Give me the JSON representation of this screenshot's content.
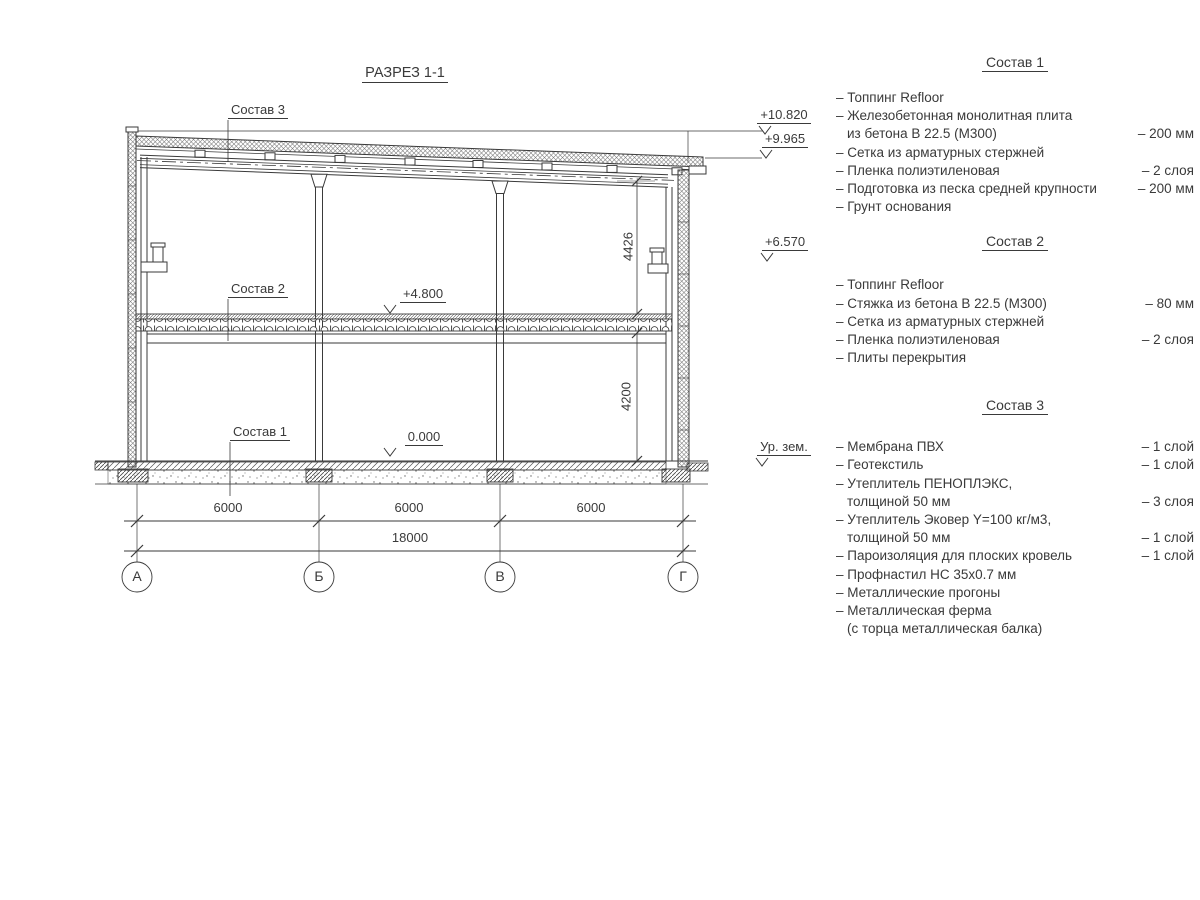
{
  "title": "РАЗРЕЗ 1-1",
  "colors": {
    "ink": "#3a3a3a",
    "background": "#ffffff"
  },
  "drawing": {
    "callouts": {
      "c3": "Состав 3",
      "c2": "Состав 2",
      "c1": "Состав 1"
    },
    "levels": {
      "l10820": "+10.820",
      "l9965": "+9.965",
      "l6570": "+6.570",
      "l4800": "+4.800",
      "l0": "0.000",
      "ground": "Ур. зем."
    },
    "vdims": {
      "upper": "4426",
      "lower": "4200"
    },
    "hdims": {
      "bays": [
        "6000",
        "6000",
        "6000"
      ],
      "total": "18000"
    },
    "axes": [
      "А",
      "Б",
      "В",
      "Г"
    ]
  },
  "panel": {
    "sections": [
      {
        "title": "Состав 1",
        "items": [
          {
            "t": "– Топпинг Refloor",
            "v": ""
          },
          {
            "t": "– Железобетонная  монолитная плита",
            "v": ""
          },
          {
            "t": "из бетона В 22.5 (М300)",
            "v": "– 200 мм",
            "ind": true
          },
          {
            "t": "– Сетка из арматурных стержней",
            "v": ""
          },
          {
            "t": "– Пленка полиэтиленовая",
            "v": "– 2 слоя"
          },
          {
            "t": "– Подготовка из песка средней крупности",
            "v": "– 200 мм"
          },
          {
            "t": "– Грунт основания",
            "v": ""
          }
        ]
      },
      {
        "title": "Состав 2",
        "items": [
          {
            "t": "– Топпинг Refloor",
            "v": ""
          },
          {
            "t": "– Стяжка из бетона В 22.5 (М300)",
            "v": "– 80 мм"
          },
          {
            "t": "– Сетка из арматурных стержней",
            "v": ""
          },
          {
            "t": "– Пленка полиэтиленовая",
            "v": "– 2 слоя"
          },
          {
            "t": "– Плиты перекрытия",
            "v": ""
          }
        ]
      },
      {
        "title": "Состав 3",
        "items": [
          {
            "t": "– Мембрана ПВХ",
            "v": "– 1 слой"
          },
          {
            "t": "– Геотекстиль",
            "v": "– 1 слой"
          },
          {
            "t": "– Утеплитель ПЕНОПЛЭКС,",
            "v": ""
          },
          {
            "t": "толщиной 50 мм",
            "v": "– 3 слоя",
            "ind": true
          },
          {
            "t": "– Утеплитель Эковер Y=100 кг/м3,",
            "v": ""
          },
          {
            "t": "толщиной 50 мм",
            "v": "– 1 слой",
            "ind": true
          },
          {
            "t": "– Пароизоляция для плоских кровель",
            "v": "– 1 слой"
          },
          {
            "t": "– Профнастил НС 35х0.7 мм",
            "v": ""
          },
          {
            "t": "– Металлические прогоны",
            "v": ""
          },
          {
            "t": "– Металлическая ферма",
            "v": ""
          },
          {
            "t": "(с торца металлическая балка)",
            "v": "",
            "ind": true
          }
        ]
      }
    ]
  }
}
